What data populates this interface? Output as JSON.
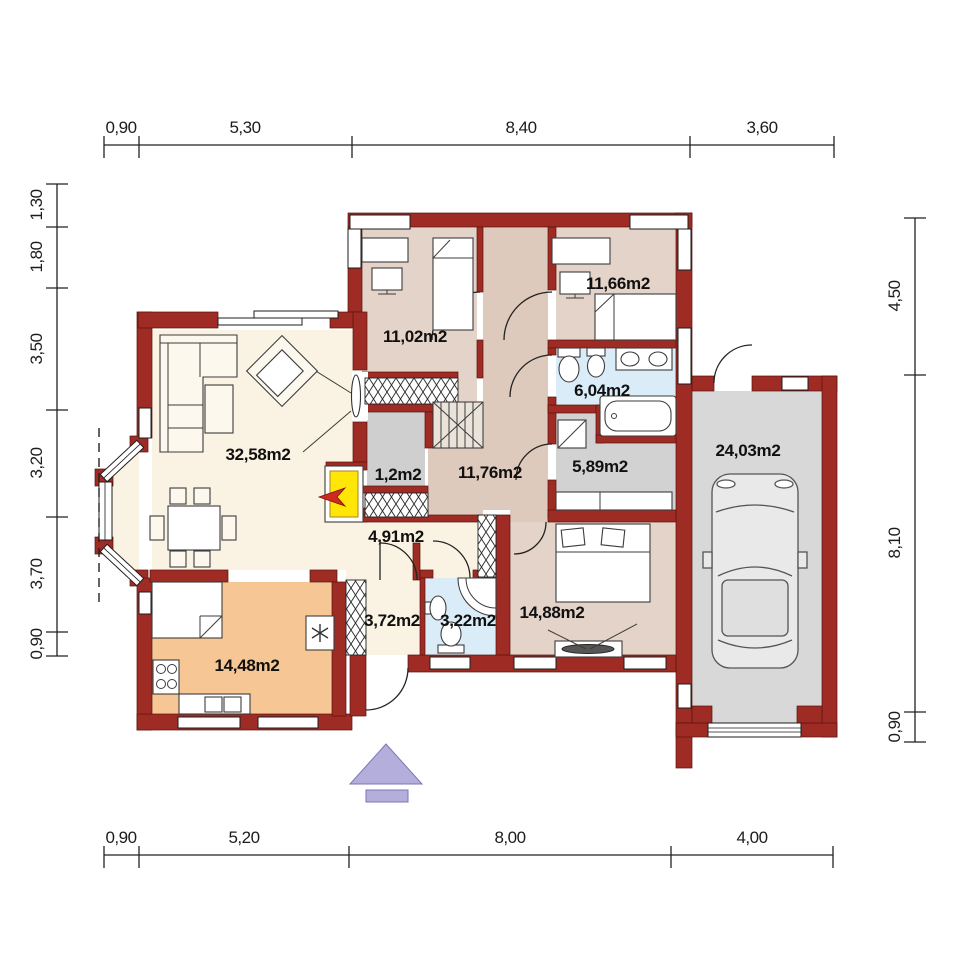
{
  "colors": {
    "wall": "#9e2b24",
    "wallEdge": "#5a150f",
    "living": "#faf3e3",
    "bedroom": "#e4d3c8",
    "hall": "#decabc",
    "bath": "#d9ecf7",
    "utilgray": "#d2d2d2",
    "garage": "#d8d8d8",
    "kitchen": "#f6c795",
    "closet": "#cfcfcf",
    "stairsbg": "#eae3da",
    "accentYellow": "#ffe607",
    "accentRed": "#cf2a20",
    "entrance": "#b3aedb",
    "text": "#101010",
    "dimtext": "#1c1c1c"
  },
  "dims": {
    "top": [
      "0,90",
      "5,30",
      "8,40",
      "3,60"
    ],
    "bottom": [
      "0,90",
      "5,20",
      "8,00",
      "4,00"
    ],
    "left": [
      "1,30",
      "1,80",
      "3,50",
      "3,20",
      "3,70",
      "0,90"
    ],
    "right": [
      "4,50",
      "8,10",
      "0,90"
    ]
  },
  "rooms": {
    "living": "32,58m2",
    "bedroom1": "11,02m2",
    "bedroom2": "11,66m2",
    "bathroom1": "6,04m2",
    "utility": "5,89m2",
    "garage": "24,03m2",
    "closet": "1,2m2",
    "hall": "11,76m2",
    "entry": "4,91m2",
    "corridor": "3,72m2",
    "bathroom2": "3,22m2",
    "bedroom3": "14,88m2",
    "kitchen": "14,48m2"
  }
}
